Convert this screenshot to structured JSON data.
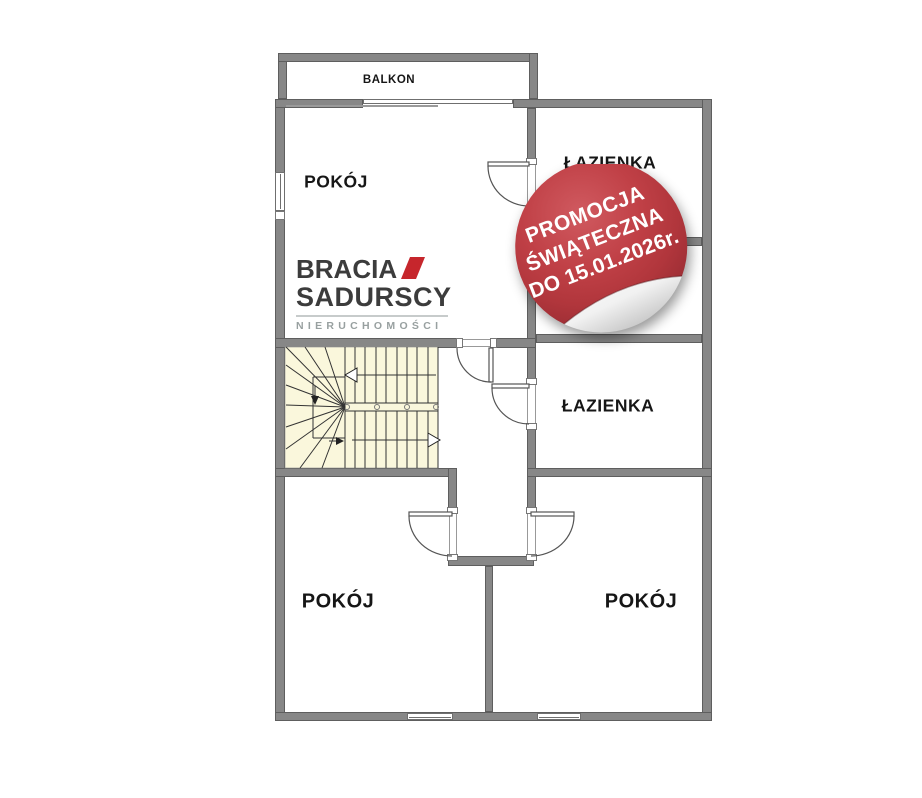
{
  "plan": {
    "rooms": [
      {
        "key": "balkon",
        "label": "BALKON"
      },
      {
        "key": "pokoj-top",
        "label": "POKÓJ"
      },
      {
        "key": "lazienka-top",
        "label": "ŁAZIENKA"
      },
      {
        "key": "room-partially-hidden",
        "label": "A"
      },
      {
        "key": "lazienka-middle",
        "label": "ŁAZIENKA"
      },
      {
        "key": "pokoj-bottom-left",
        "label": "POKÓJ"
      },
      {
        "key": "pokoj-bottom-right",
        "label": "POKÓJ"
      }
    ]
  },
  "logo": {
    "brand_line1": "BRACIA",
    "brand_line2": "SADURSCY",
    "subtitle": "NIERUCHOMOŚCI",
    "accent_color": "#c6262c"
  },
  "sticker": {
    "line1": "PROMOCJA",
    "line2": "ŚWIĄTECZNA",
    "line3": "DO 15.01.2026r.",
    "bg_color": "#b1363c",
    "text_color": "#ffffff"
  },
  "colors": {
    "wall_fill": "#878787",
    "wall_border": "#5e5e5e",
    "stairs_fill": "#faf7dc"
  }
}
